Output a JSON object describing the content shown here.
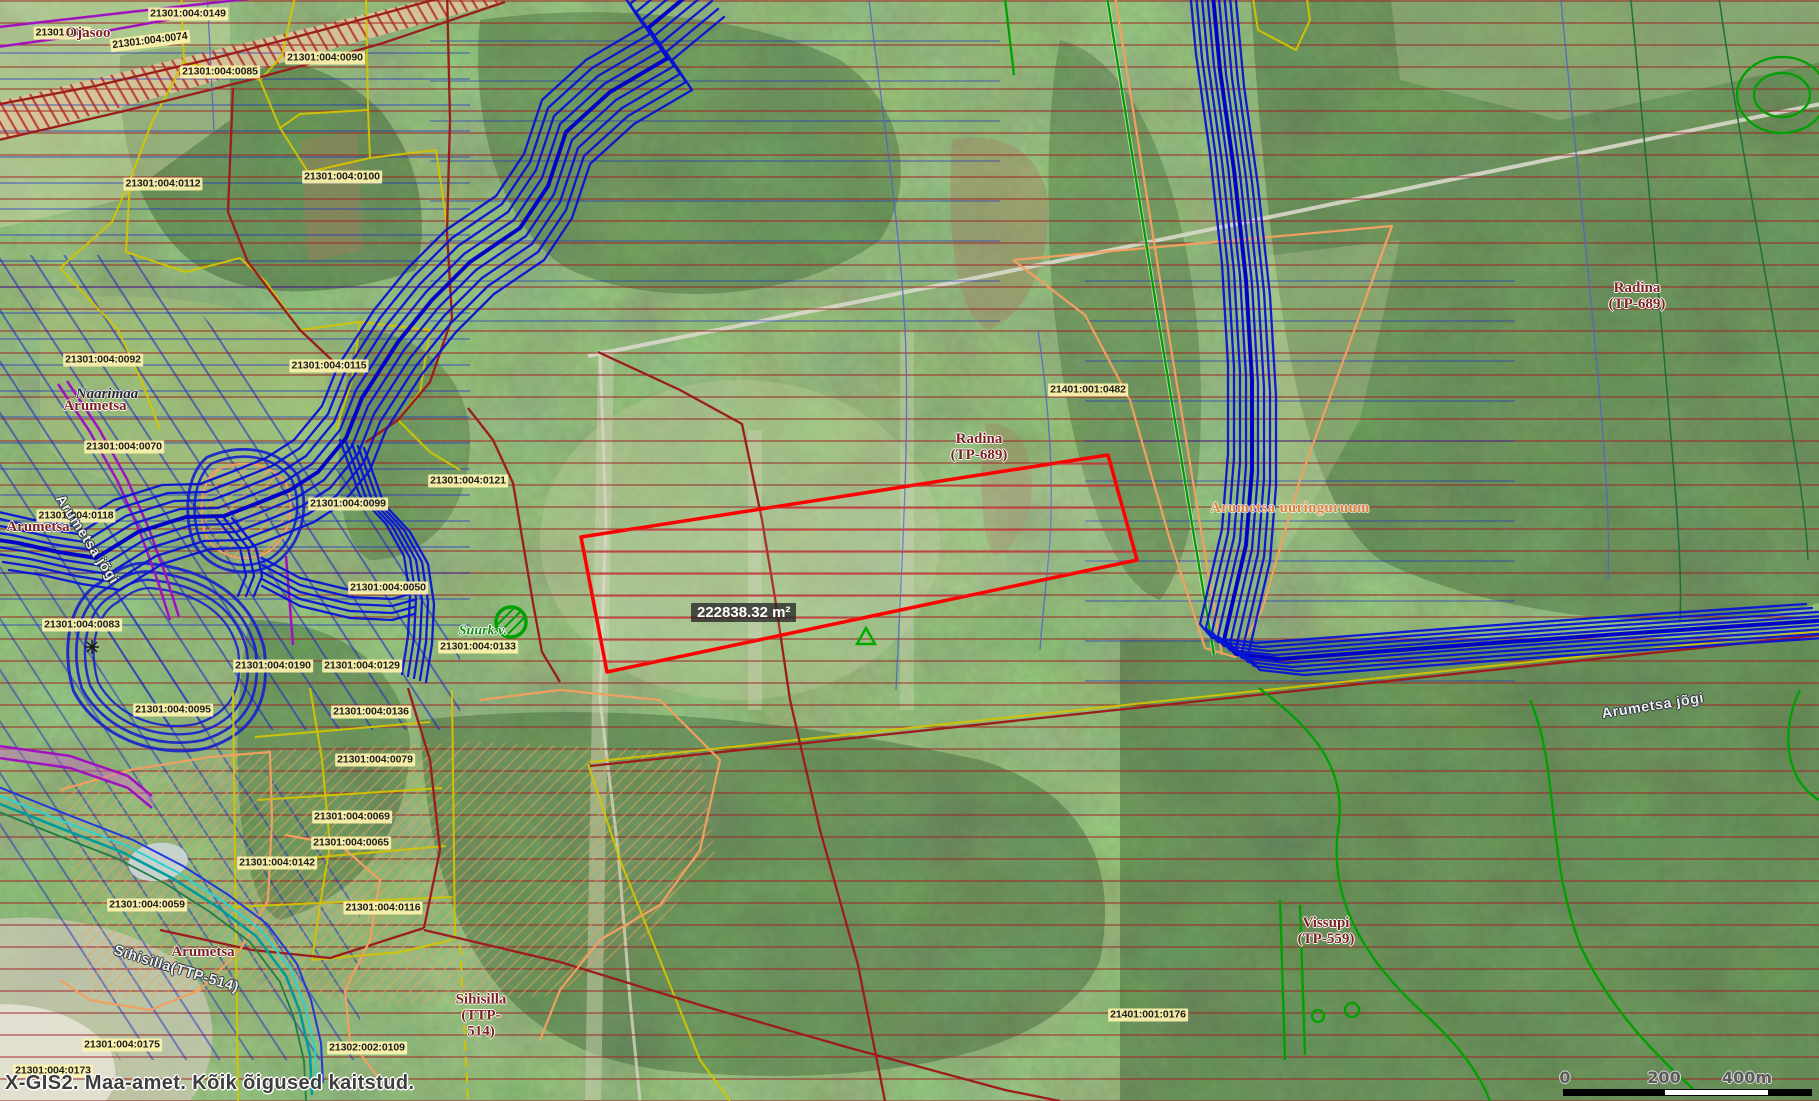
{
  "app": {
    "name": "X-GIS2",
    "attribution": "X-GIS2. Maa-amet. Kõik õigused kaitstud."
  },
  "selection": {
    "area_label": "222838.32 m²"
  },
  "scale_bar": {
    "labels": [
      "0",
      "200",
      "400m"
    ]
  },
  "map": {
    "cadastral_labels": [
      {
        "text": "21301:004:0149",
        "x": 188,
        "y": 14
      },
      {
        "text": "21301:004:",
        "x": 62,
        "y": 33
      },
      {
        "text": "21301:004:0074",
        "x": 150,
        "y": 41,
        "rot": -7
      },
      {
        "text": "21301:004:0085",
        "x": 220,
        "y": 72
      },
      {
        "text": "21301:004:0090",
        "x": 325,
        "y": 58
      },
      {
        "text": "21301:004:0100",
        "x": 342,
        "y": 177
      },
      {
        "text": "21301:004:0112",
        "x": 163,
        "y": 184
      },
      {
        "text": "21301:004:0092",
        "x": 103,
        "y": 360
      },
      {
        "text": "21301:004:0115",
        "x": 329,
        "y": 366
      },
      {
        "text": "21301:004:0070",
        "x": 124,
        "y": 447
      },
      {
        "text": "21301:004:0118",
        "x": 76,
        "y": 516
      },
      {
        "text": "21301:004:0121",
        "x": 468,
        "y": 481
      },
      {
        "text": "21301:004:0099",
        "x": 348,
        "y": 504
      },
      {
        "text": "21301:004:0050",
        "x": 388,
        "y": 588
      },
      {
        "text": "21301:004:0083",
        "x": 82,
        "y": 625
      },
      {
        "text": "21301:004:0133",
        "x": 478,
        "y": 647
      },
      {
        "text": "21301:004:0190",
        "x": 273,
        "y": 666
      },
      {
        "text": "21301:004:0129",
        "x": 362,
        "y": 666
      },
      {
        "text": "21301:004:0095",
        "x": 173,
        "y": 710
      },
      {
        "text": "21301:004:0136",
        "x": 371,
        "y": 712
      },
      {
        "text": "21301:004:0079",
        "x": 375,
        "y": 760
      },
      {
        "text": "21301:004:0069",
        "x": 352,
        "y": 817
      },
      {
        "text": "21301:004:0065",
        "x": 351,
        "y": 843
      },
      {
        "text": "21301:004:0142",
        "x": 277,
        "y": 863
      },
      {
        "text": "21301:004:0059",
        "x": 147,
        "y": 905
      },
      {
        "text": "21301:004:0116",
        "x": 383,
        "y": 908
      },
      {
        "text": "21302:002:0109",
        "x": 367,
        "y": 1048
      },
      {
        "text": "21301:004:0175",
        "x": 122,
        "y": 1045
      },
      {
        "text": "21301:004:0173",
        "x": 53,
        "y": 1071
      },
      {
        "text": "21401:001:0482",
        "x": 1088,
        "y": 390
      },
      {
        "text": "21401:001:0176",
        "x": 1148,
        "y": 1015
      }
    ],
    "place_labels": [
      {
        "text": "Ojasoo",
        "x": 88,
        "y": 33,
        "cls": "dr"
      },
      {
        "text": "Naarimaa",
        "x": 107,
        "y": 394,
        "cls": "bi"
      },
      {
        "text": "Arumetsa",
        "x": 95,
        "y": 406,
        "cls": "dr"
      },
      {
        "text": "Arumetsa",
        "x": 38,
        "y": 527,
        "cls": "dr"
      },
      {
        "text": "Arumetsa",
        "x": 203,
        "y": 952,
        "cls": "dr"
      },
      {
        "text": "Radina\n(TP-689)",
        "x": 1637,
        "y": 296,
        "cls": "dr"
      },
      {
        "text": "Radina\n(TP-689)",
        "x": 979,
        "y": 447,
        "cls": "dr"
      },
      {
        "text": "Vissupi\n(TP-559)",
        "x": 1326,
        "y": 931,
        "cls": "dr"
      },
      {
        "text": "Sihisilla\n(TTP-\n514)",
        "x": 481,
        "y": 1016,
        "cls": "dr"
      },
      {
        "text": "Sihisilla(TTP-514)",
        "x": 176,
        "y": 970,
        "cls": "river",
        "rot": 17
      },
      {
        "text": "Arumetsa jõgi",
        "x": 86,
        "y": 540,
        "cls": "river",
        "rot": 57
      },
      {
        "text": "Arumetsa jõgi",
        "x": 1653,
        "y": 707,
        "cls": "river",
        "rot": -9
      },
      {
        "text": "Suurk.v.",
        "x": 483,
        "y": 631,
        "cls": "green"
      },
      {
        "text": "Arumetsa uuringuruum",
        "x": 1290,
        "y": 509,
        "cls": "orange"
      }
    ]
  },
  "colors": {
    "parcel_boundary_yellow": "#d4c400",
    "boundary_dark_red": "#9b1d1d",
    "selection_red": "#ff0000",
    "river_blue": "#0613d6",
    "restriction_hatch_red": "#9e2020",
    "survey_orange": "#f0a060",
    "road_green": "#00a000",
    "utility_magenta": "#a012c0",
    "stream_teal": "#009c9c",
    "label_background": "#fdf3ae"
  }
}
